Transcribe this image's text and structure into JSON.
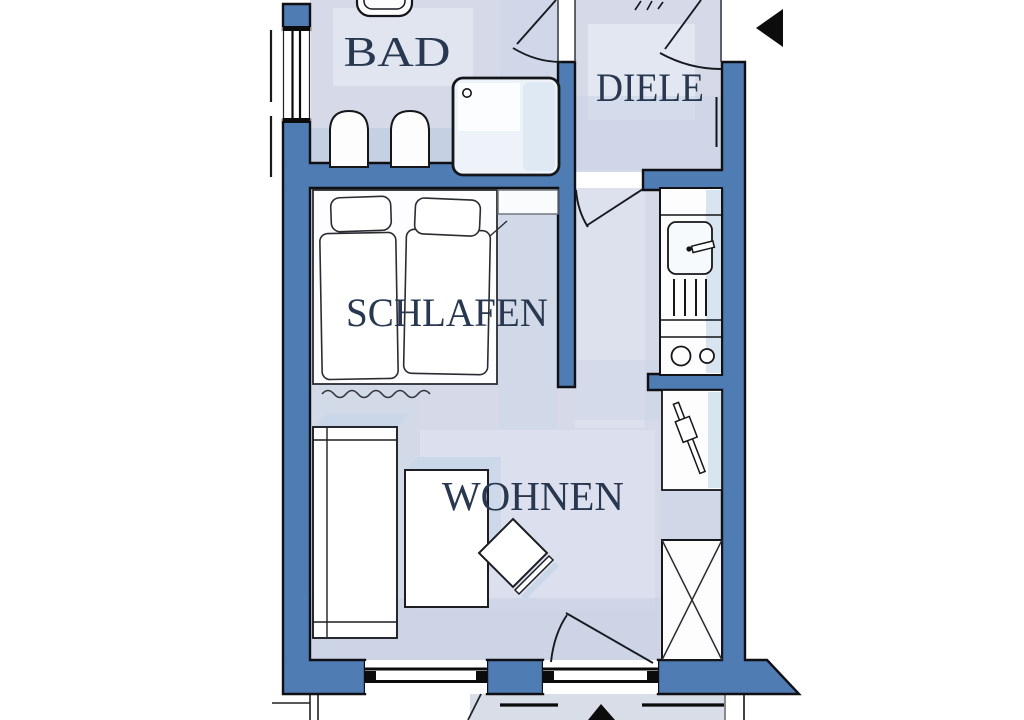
{
  "page": {
    "type": "apartment floor plan",
    "background": "#ffffff"
  },
  "rooms": {
    "bad": {
      "label": "BAD"
    },
    "diele": {
      "label": "DIELE"
    },
    "schlafen": {
      "label": "SCHLAFEN"
    },
    "wohnen": {
      "label": "WOHNEN"
    }
  },
  "colors": {
    "wall_fill": "#4e7cb3",
    "outline": "#101014",
    "floor_base": "#d6dae8",
    "floor_shade": "#c6d1e4",
    "floor_light": "#e5e9f2",
    "furniture_fill": "#fdfdfe",
    "fixture_tint": "#d9e4f1",
    "balcony_floor": "#d9dde8",
    "label_text": "#273850",
    "entrance_arrow": "#0c0c0c"
  },
  "symbols": {
    "entrance_arrow": "entrance-direction-arrow",
    "toilet": "toilet",
    "basins": "twin-pedestal-fixtures",
    "shower": "shower-tray-with-drain",
    "kitchen_sink": "kitchen-sink-with-faucet",
    "drainer": "drainer-grooves",
    "cooktop": "two-burner-cooktop",
    "heater": "wall-heater",
    "wardrobe": "wardrobe-crossed",
    "double_bed": "double-bed-with-pillows",
    "nightstand": "wall-shelf",
    "sofa": "sofa-daybed",
    "table": "table",
    "chair": "rotated-chair",
    "rug": "wavy-rug-line",
    "windows": "double-line-windows",
    "doors": "door-swing-arcs",
    "balcony": "balcony-below"
  }
}
